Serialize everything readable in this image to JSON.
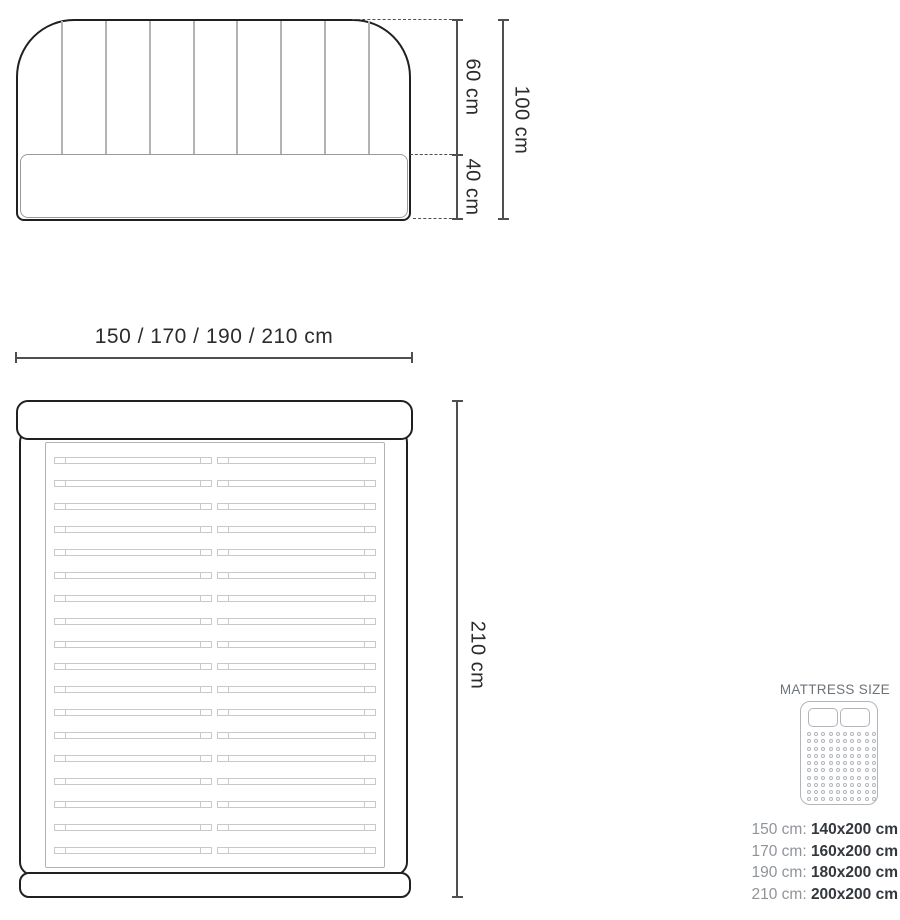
{
  "front_view": {
    "headboard_height_label": "60 cm",
    "base_height_label": "40 cm",
    "total_height_label": "100 cm",
    "tufting_line_count": 8
  },
  "width_dimension": {
    "label": "150 / 170 / 190 / 210 cm"
  },
  "top_view": {
    "length_label": "210 cm",
    "slat_count": 18
  },
  "mattress_legend": {
    "title": "MATTRESS SIZE",
    "icon": "mattress-top-view-icon",
    "dot_grid": {
      "rows": 10,
      "cols": 10
    },
    "rows": [
      {
        "frame_size": "150 cm:",
        "mattress_size": "140x200 cm"
      },
      {
        "frame_size": "170 cm:",
        "mattress_size": "160x200 cm"
      },
      {
        "frame_size": "190 cm:",
        "mattress_size": "180x200 cm"
      },
      {
        "frame_size": "210 cm:",
        "mattress_size": "200x200 cm"
      }
    ]
  },
  "colors": {
    "outline_dark": "#202020",
    "dimension_line": "#4f4f4f",
    "tufting_gray": "#b3b3b3",
    "slat_gray": "#c9c9c9",
    "legend_gray": "#8f9499",
    "legend_dark": "#34383d",
    "icon_gray": "#b2b6ba"
  }
}
